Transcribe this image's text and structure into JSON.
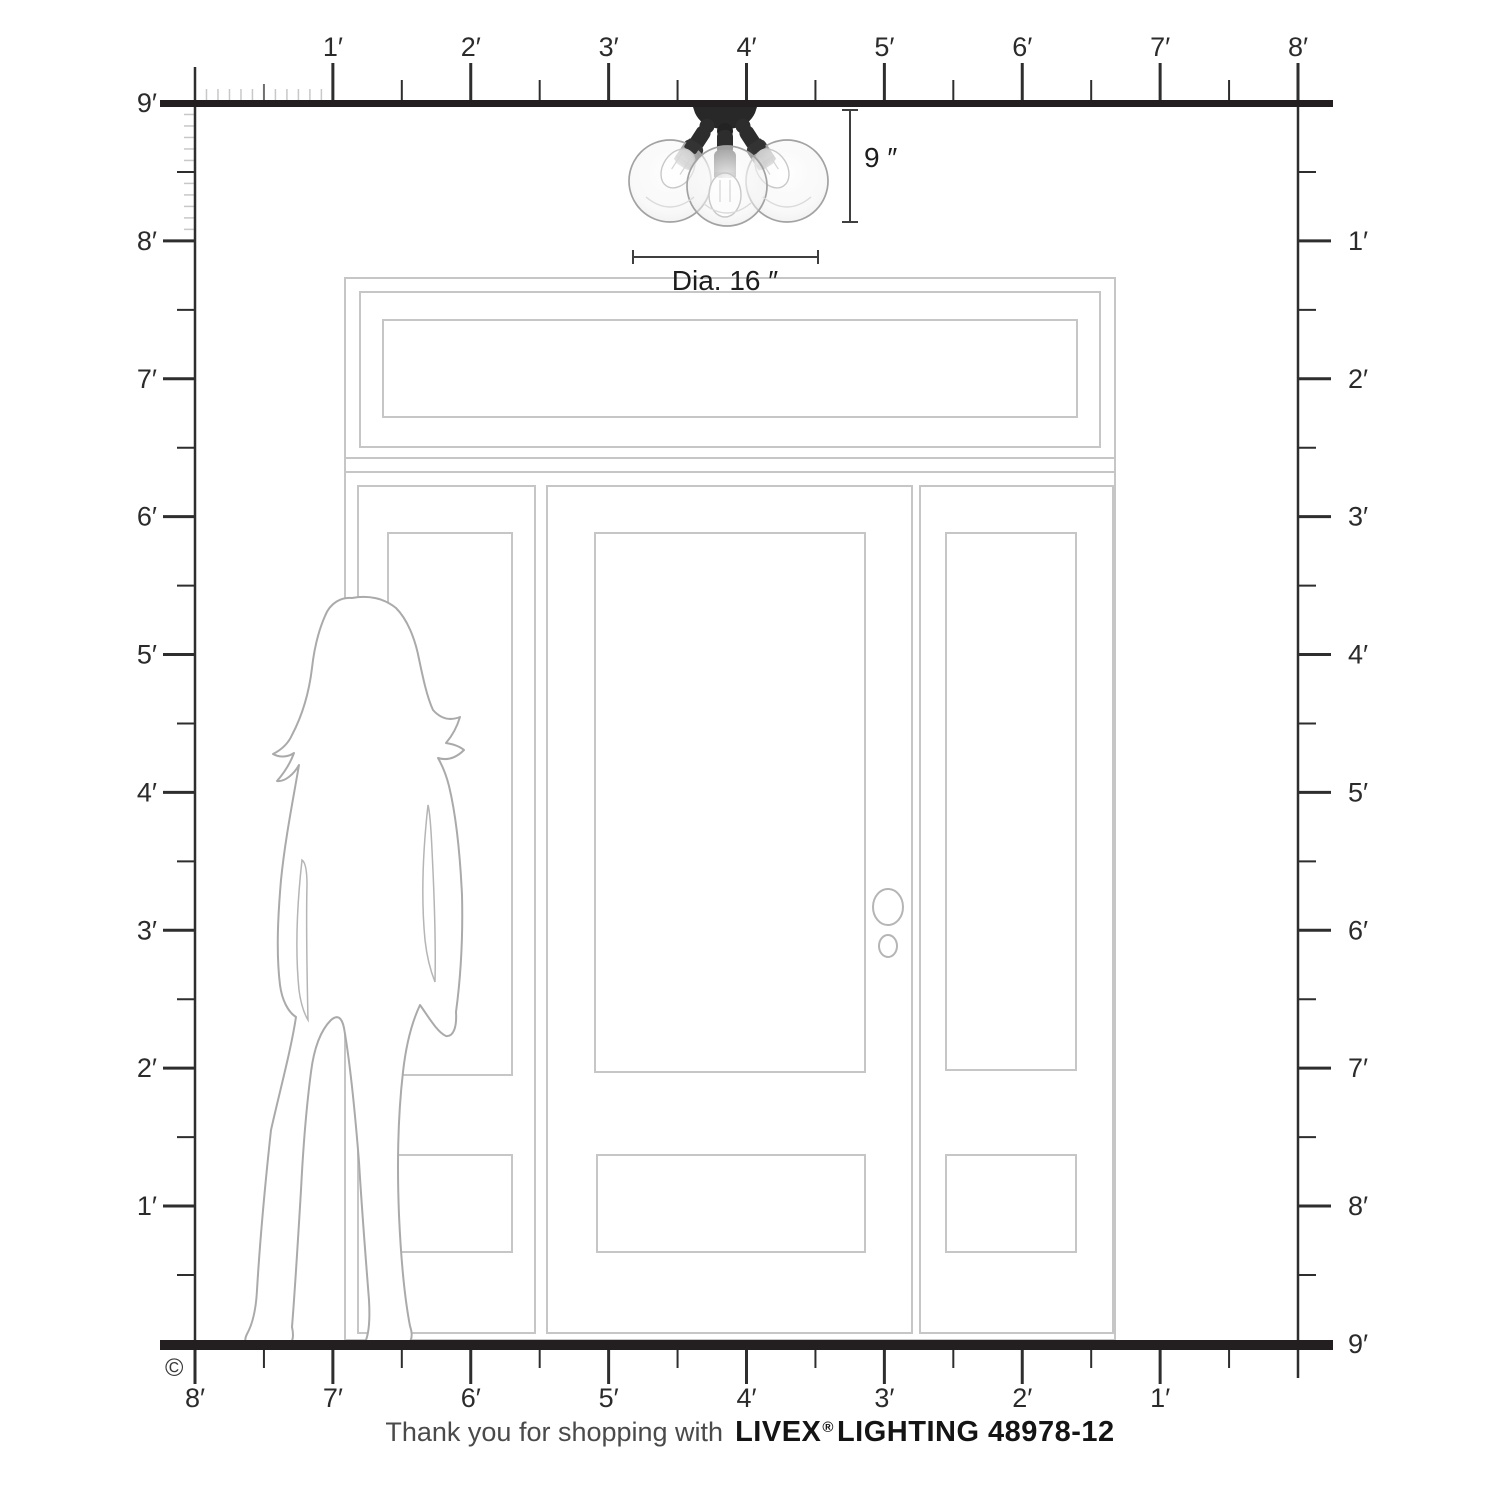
{
  "figure": {
    "copyright_symbol": "©",
    "footer": {
      "message": "Thank you for shopping with",
      "brand": "LIVEX",
      "registered_mark": "®",
      "brand_suffix": "LIGHTING 48978-12"
    }
  },
  "dimension_labels": {
    "height": "9 ″",
    "diameter": "Dia. 16 ″"
  },
  "rulers": {
    "unit": "feet",
    "top_labels": [
      "1′",
      "2′",
      "3′",
      "4′",
      "5′",
      "6′",
      "7′",
      "8′"
    ],
    "left_labels": [
      "9′",
      "8′",
      "7′",
      "6′",
      "5′",
      "4′",
      "3′",
      "2′",
      "1′"
    ],
    "right_labels": [
      "1′",
      "2′",
      "3′",
      "4′",
      "5′",
      "6′",
      "7′",
      "8′",
      "9′"
    ],
    "bottom_labels": [
      "8′",
      "7′",
      "6′",
      "5′",
      "4′",
      "3′",
      "2′",
      "1′"
    ]
  },
  "colors": {
    "ruler_line": "#2e2e2e",
    "thick_line": "#231f20",
    "inch_tick": "#c8c8c8",
    "half_inch_tick": "#6f6f6f",
    "door_outline": "#c6c6c6",
    "silhouette_outline": "#aaaaaa",
    "fixture_dark": "#2b2b2b",
    "glass_outline": "#a2a2a2",
    "dimension_line": "#3f3f3f"
  }
}
